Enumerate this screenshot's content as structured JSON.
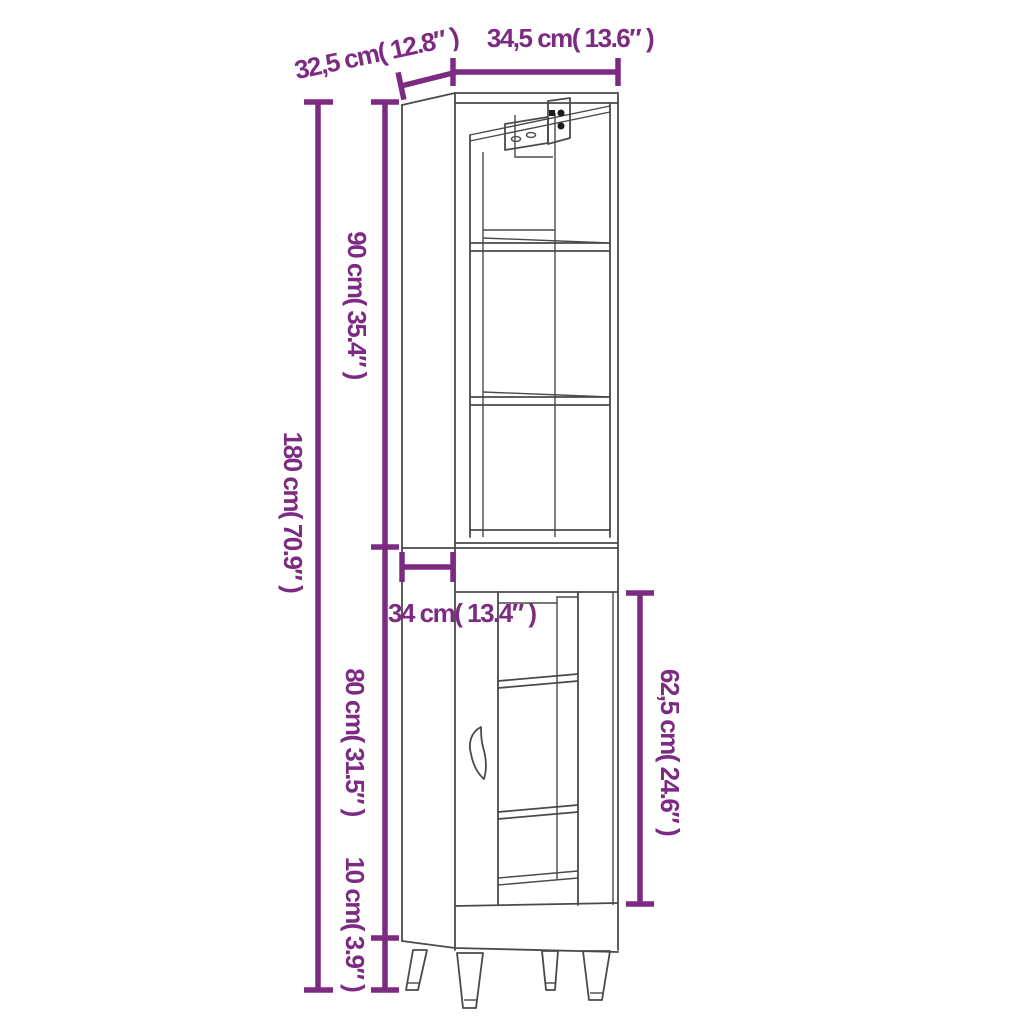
{
  "diagram": {
    "type": "furniture-dimension-diagram",
    "subject": "tall-cabinet-with-legs",
    "background": "#ffffff",
    "accent_color": "#7d2a82",
    "line_color": "#4a4a4a",
    "dimensions": {
      "top_depth": "32,5 cm( 12.8″ )",
      "top_width": "34,5 cm( 13.6″ )",
      "total_height": "180 cm( 70.9″ )",
      "upper_height": "90 cm( 35.4″ )",
      "lower_depth": "34 cm( 13.4″ )",
      "lower_height": "80 cm( 31.5″ )",
      "leg_height": "10 cm( 3.9″ )",
      "door_height": "62,5 cm( 24.6″ )"
    }
  }
}
